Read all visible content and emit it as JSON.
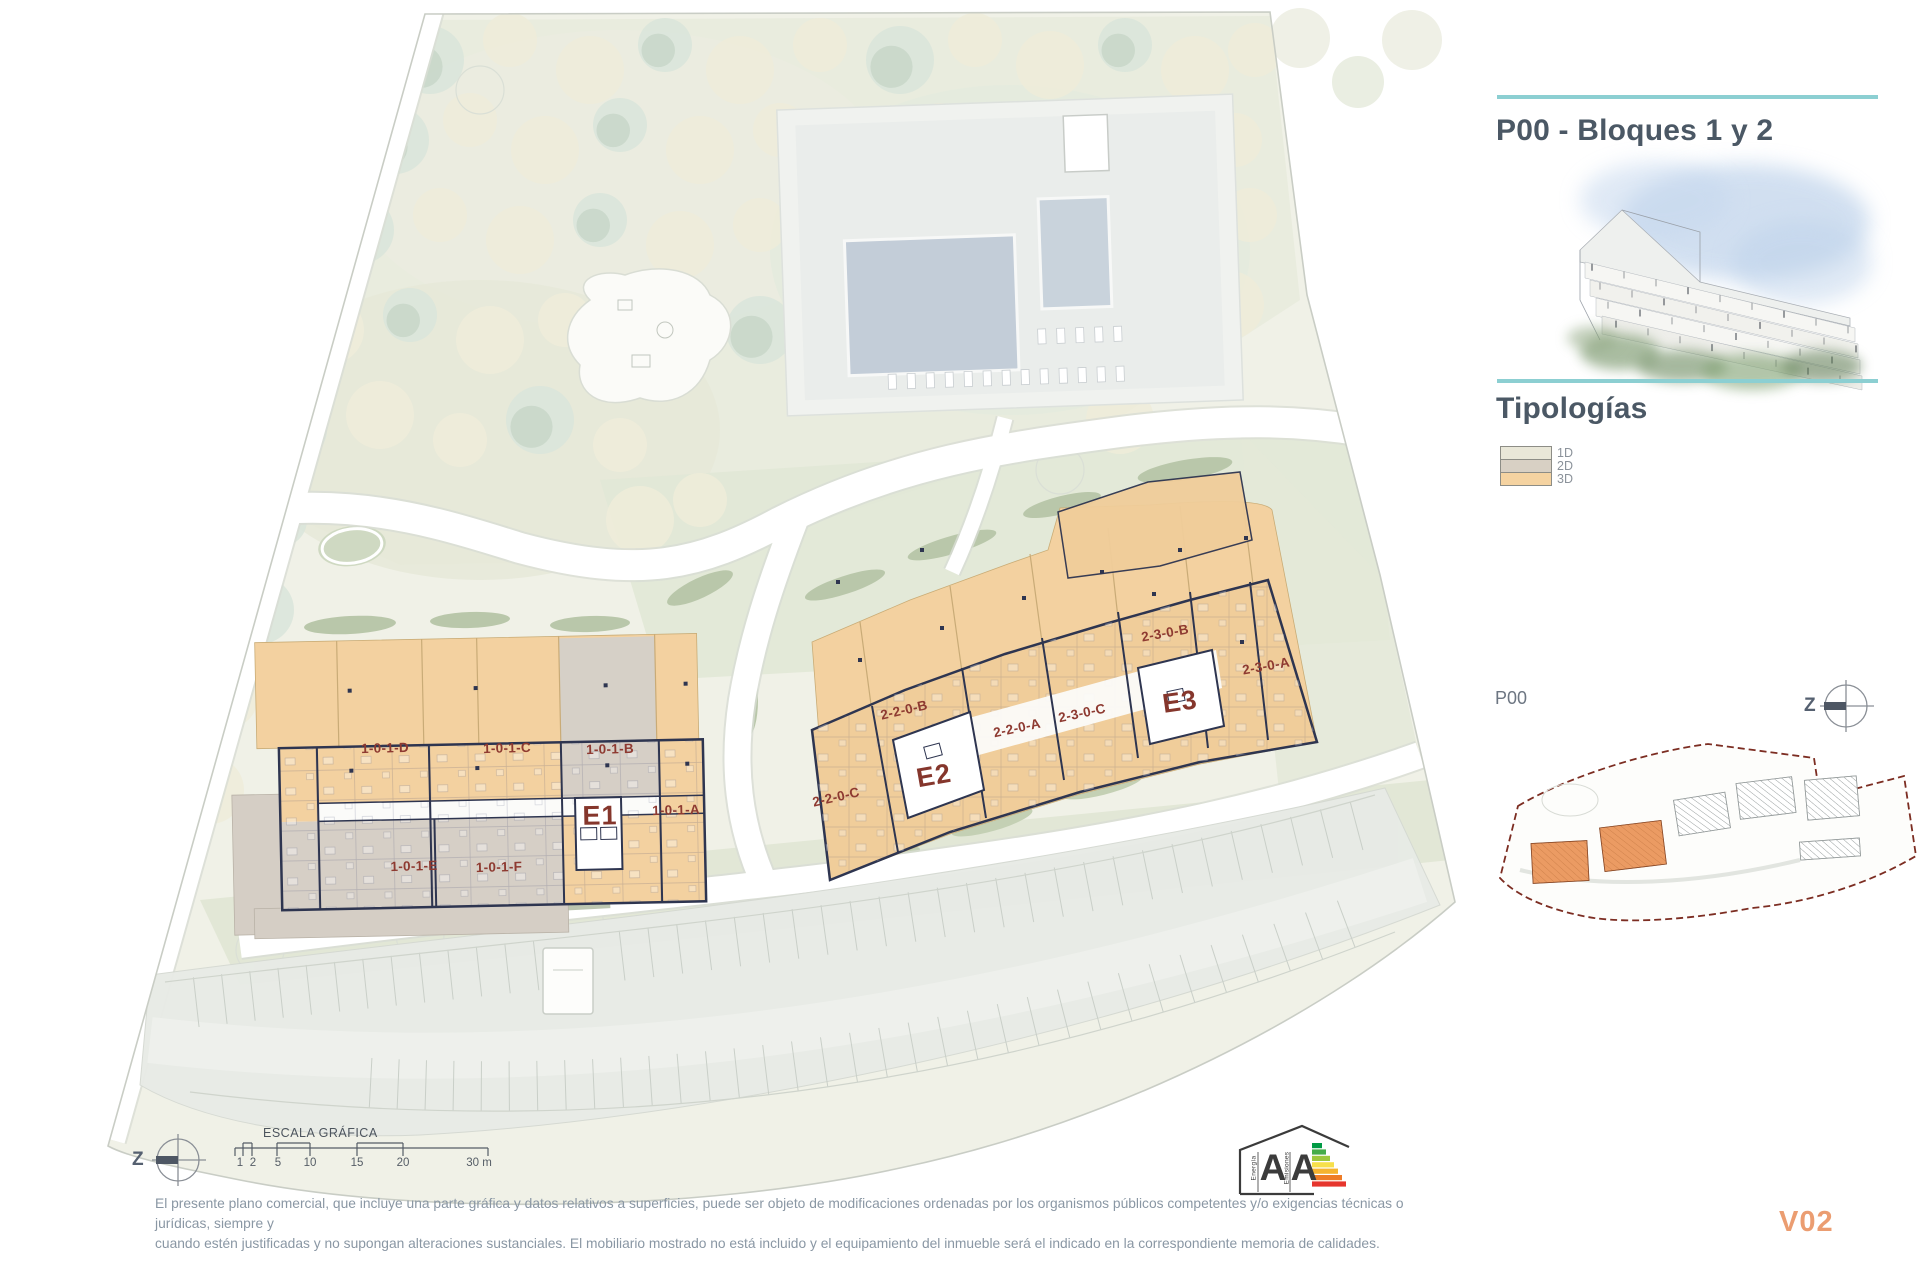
{
  "header": {
    "title": "P00 - Bloques 1 y 2"
  },
  "typologies": {
    "heading": "Tipologías",
    "items": [
      {
        "label": "1D",
        "color": "#e9e7d8"
      },
      {
        "label": "2D",
        "color": "#d8d0c4"
      },
      {
        "label": "3D",
        "color": "#f5d3a1"
      }
    ]
  },
  "key_plan": {
    "label": "P00",
    "compass_letter": "Z"
  },
  "plan": {
    "compass_letter": "Z",
    "labels": [
      {
        "text": "1-0-1-D"
      },
      {
        "text": "1-0-1-C"
      },
      {
        "text": "1-0-1-B"
      },
      {
        "text": "1-0-1-A"
      },
      {
        "text": "1-0-1-E"
      },
      {
        "text": "1-0-1-F"
      },
      {
        "text": "E1"
      },
      {
        "text": "2-2-0-C"
      },
      {
        "text": "2-2-0-B"
      },
      {
        "text": "2-2-0-A"
      },
      {
        "text": "2-3-0-C"
      },
      {
        "text": "2-3-0-B"
      },
      {
        "text": "2-3-0-A"
      },
      {
        "text": "E2"
      },
      {
        "text": "E3"
      }
    ]
  },
  "scale_bar": {
    "title": "ESCALA GRÁFICA",
    "ticks": [
      "1",
      "2",
      "5",
      "10",
      "15",
      "20",
      "30 m"
    ]
  },
  "energy_badge": {
    "letters": [
      "A",
      "A"
    ],
    "words": [
      "Energía",
      "Emisiones"
    ],
    "bar_colors": [
      "#009a44",
      "#45ac49",
      "#9dc83d",
      "#f7e04b",
      "#f5b32f",
      "#ee7c26",
      "#e6352d"
    ]
  },
  "disclaimer": {
    "line1": "El presente plano comercial, que incluye una parte gráfica y datos relativos a superficies, puede ser objeto de modificaciones ordenadas por los organismos públicos competentes y/o exigencias técnicas o jurídicas, siempre y",
    "line2": "cuando estén justificadas y no supongan alteraciones sustanciales. El mobiliario mostrado no está incluido y el equipamiento del inmueble será el indicado en la correspondiente memoria de calidades."
  },
  "version": {
    "label": "V02"
  },
  "colors": {
    "accent_teal": "#8ccfd2",
    "title_slate": "#4b5865",
    "unit_label_red": "#8e3a31",
    "typology_1d": "#e9e7d8",
    "typology_2d": "#d8d0c4",
    "typology_3d": "#f5d3a1",
    "keyplan_boundary": "#7c2d22",
    "keyplan_highlight": "#eb9b63",
    "version_orange": "#eb9d71"
  }
}
